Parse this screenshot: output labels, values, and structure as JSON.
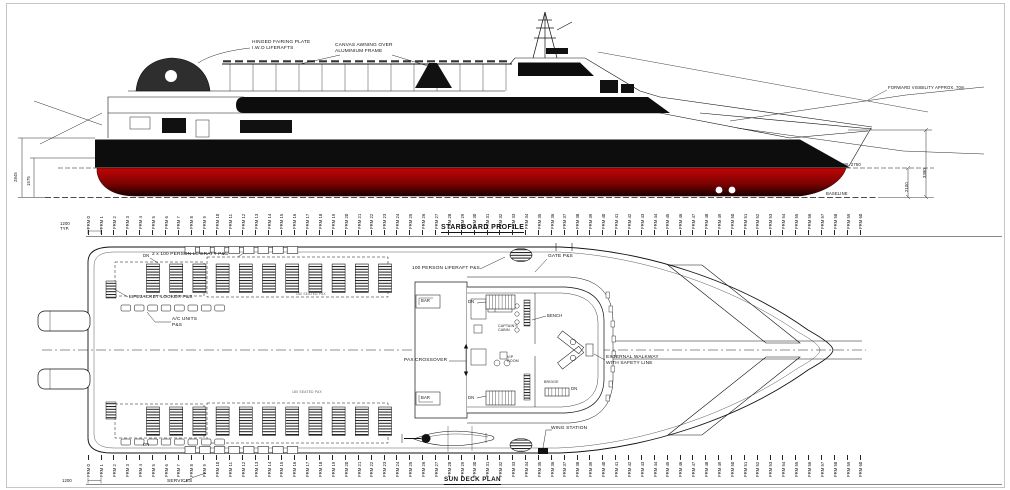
{
  "titles": {
    "profile": "STARBOARD PROFILE",
    "plan": "SUN DECK PLAN"
  },
  "profile": {
    "labels": {
      "hinged_fairing": "HINGED FAIRING PLATE\nI.W.O LIFERAFTS",
      "canvas_awning": "CANVAS AWNING OVER\nALUMINIUM FRAME",
      "forward_visibility": "FORWARD VISIBILITY APPROX. 70m",
      "dwl": "DWL 2750",
      "baseline": "BASELINE",
      "dim_2845": "2845",
      "dim_1575": "1575",
      "dim_2100": "2100",
      "dim_3380": "3380"
    }
  },
  "plan": {
    "labels": {
      "liferaft_2x": "2 x 100 PERSON LIFERAFT P&S",
      "lifejacket_locker": "LIFEJACKET LOCKER P&S",
      "ac_units": "A/C UNITS\nP&S",
      "liferaft_100": "100 PERSON LIFERAFT P&S",
      "gate": "GATE P&S",
      "bar": "BAR",
      "bench": "BENCH",
      "captains_cabin": "CAPTAIN'S\nCABIN",
      "vip_room": "VIP\nROOM",
      "bridge": "BRIDGE",
      "pax_crossover": "PAX CROSSOVER",
      "external_walkway": "EXTERNAL WALKWAY\nWITH SAFETY LINE",
      "wing_station": "WING STATION",
      "dn": "DN",
      "seated_pax": "180 SEATED PAX",
      "services": "SERVICES"
    }
  },
  "ruler": {
    "typ_top": "1200\nTYP.",
    "typ_bottom": "1200",
    "frames": [
      "FRM 0",
      "FRM 1",
      "FRM 2",
      "FRM 3",
      "FRM 4",
      "FRM 5",
      "FRM 6",
      "FRM 7",
      "FRM 8",
      "FRM 9",
      "FRM 10",
      "FRM 11",
      "FRM 12",
      "FRM 13",
      "FRM 14",
      "FRM 15",
      "FRM 16",
      "FRM 17",
      "FRM 18",
      "FRM 19",
      "FRM 20",
      "FRM 21",
      "FRM 22",
      "FRM 23",
      "FRM 24",
      "FRM 25",
      "FRM 26",
      "FRM 27",
      "FRM 28",
      "FRM 29",
      "FRM 30",
      "FRM 31",
      "FRM 32",
      "FRM 33",
      "FRM 34",
      "FRM 35",
      "FRM 36",
      "FRM 37",
      "FRM 38",
      "FRM 39",
      "FRM 40",
      "FRM 41",
      "FRM 42",
      "FRM 43",
      "FRM 44",
      "FRM 45",
      "FRM 46",
      "FRM 47",
      "FRM 48",
      "FRM 49",
      "FRM 50",
      "FRM 51",
      "FRM 52",
      "FRM 53",
      "FRM 54",
      "FRM 55",
      "FRM 56",
      "FRM 57",
      "FRM 58",
      "FRM 59",
      "FRM 60"
    ]
  },
  "colors": {
    "hull_black": "#0d0d0d",
    "antifouling_red_top": "#c00505",
    "antifouling_red_bottom": "#1b0000",
    "line": "#111111"
  }
}
